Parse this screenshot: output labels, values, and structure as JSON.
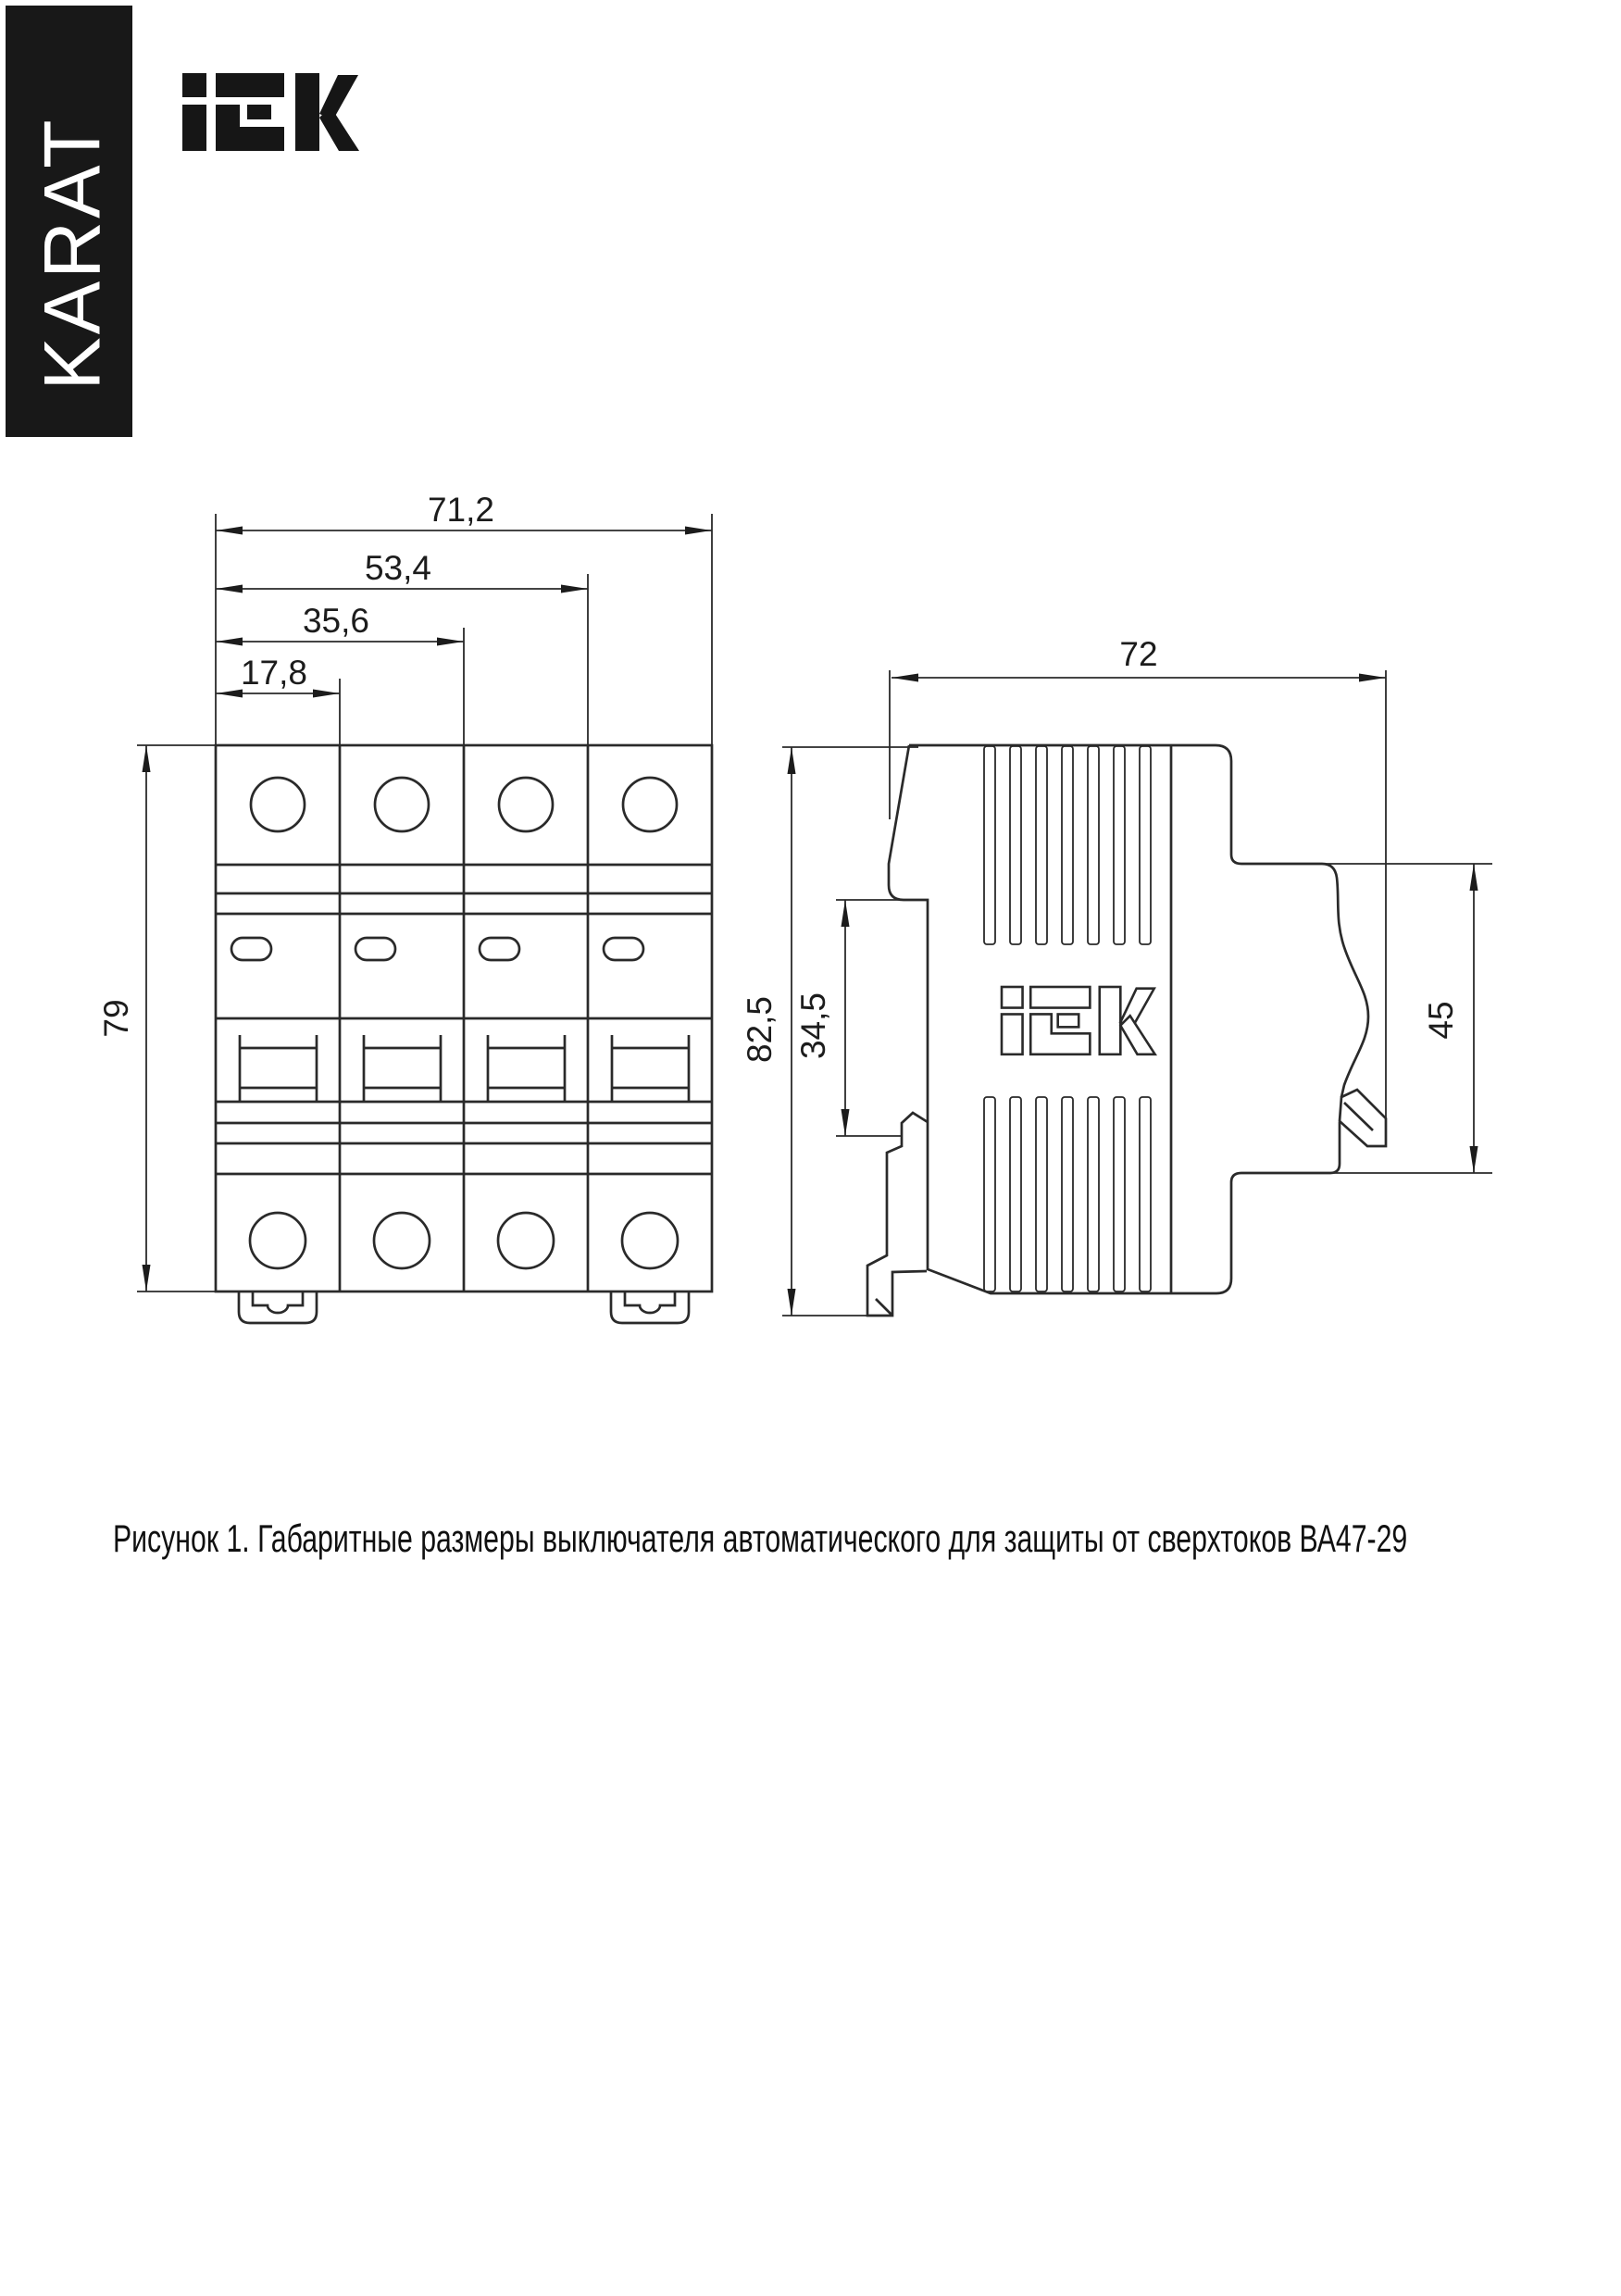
{
  "banner": {
    "text": "KARAT"
  },
  "header": {
    "logo_icon": "IEK"
  },
  "figure": {
    "caption": "Рисунок 1. Габаритные размеры выключателя автоматического для защиты от сверхтоков ВА47-29",
    "product": "ВА47-29",
    "front_view": {
      "name": "front view, 4-pole circuit breaker",
      "width_total": "71,2",
      "width_three_modules": "53,4",
      "width_two_modules": "35,6",
      "width_one_module": "17,8",
      "height": "79"
    },
    "side_view": {
      "name": "side view",
      "depth": "72",
      "height_total": "82,5",
      "din_rail_section": "34,5",
      "front_part_height": "45",
      "logo_icon": "IEK"
    }
  },
  "colors": {
    "line": "#2a2a2a",
    "banner_bg": "#181818",
    "banner_text": "#ffffff",
    "background": "#ffffff"
  }
}
